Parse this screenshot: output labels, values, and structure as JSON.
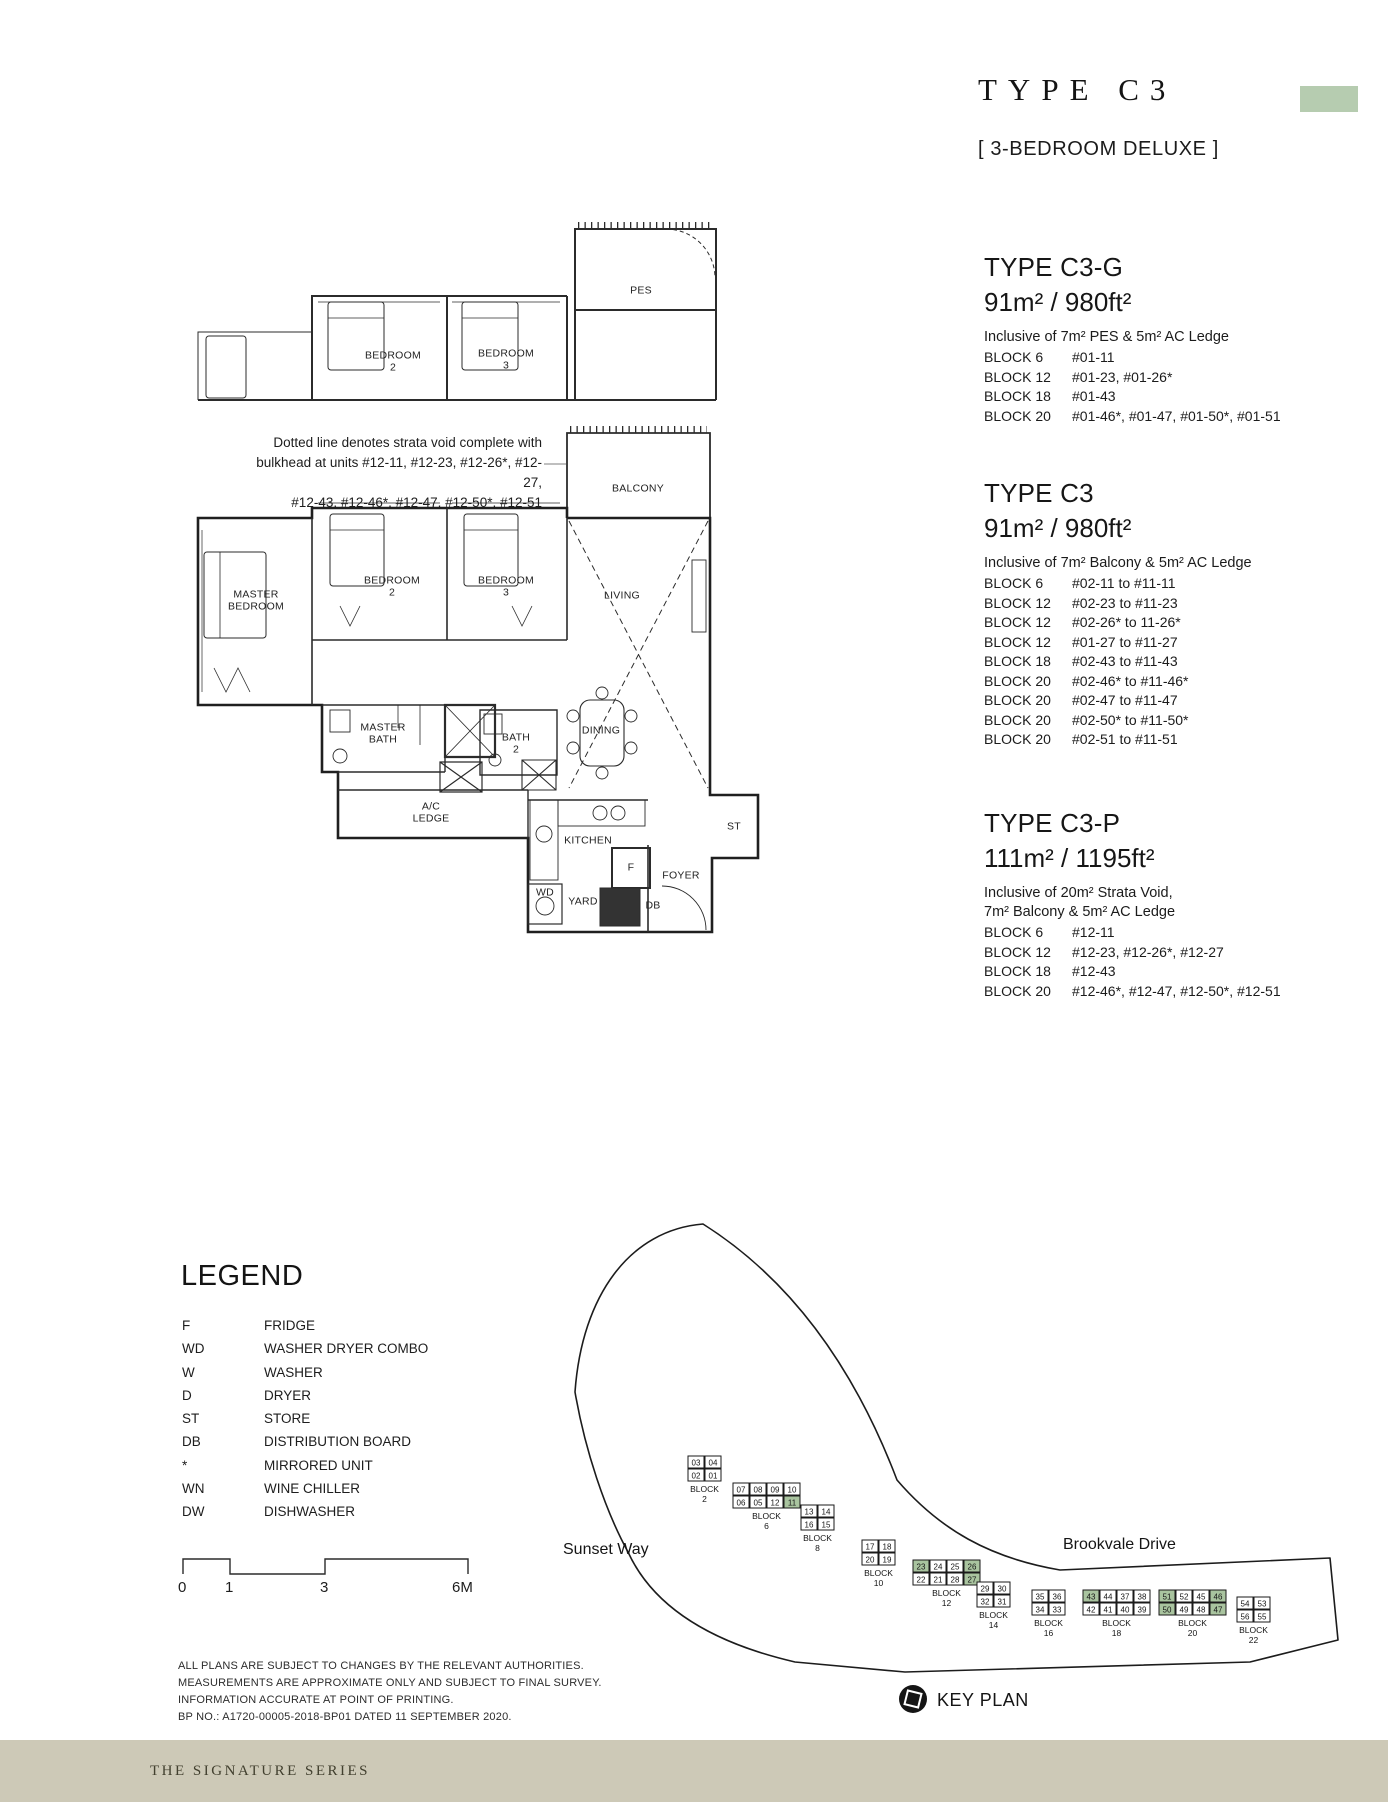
{
  "header": {
    "title": "TYPE C3",
    "subtitle": "[ 3-BEDROOM DELUXE ]"
  },
  "unit_types": [
    {
      "name": "TYPE C3-G",
      "area": "91m² / 980ft²",
      "inclusive": [
        "Inclusive of 7m² PES & 5m² AC Ledge"
      ],
      "blocks": [
        {
          "block": "BLOCK 6",
          "units": "#01-11"
        },
        {
          "block": "BLOCK 12",
          "units": "#01-23, #01-26*"
        },
        {
          "block": "BLOCK 18",
          "units": "#01-43"
        },
        {
          "block": "BLOCK 20",
          "units": "#01-46*, #01-47, #01-50*, #01-51"
        }
      ]
    },
    {
      "name": "TYPE C3",
      "area": "91m² / 980ft²",
      "inclusive": [
        "Inclusive of 7m² Balcony & 5m² AC Ledge"
      ],
      "blocks": [
        {
          "block": "BLOCK 6",
          "units": "#02-11 to #11-11"
        },
        {
          "block": "BLOCK 12",
          "units": "#02-23 to #11-23"
        },
        {
          "block": "BLOCK 12",
          "units": "#02-26* to 11-26*"
        },
        {
          "block": "BLOCK 12",
          "units": "#01-27 to #11-27"
        },
        {
          "block": "BLOCK 18",
          "units": "#02-43 to #11-43"
        },
        {
          "block": "BLOCK 20",
          "units": "#02-46* to #11-46*"
        },
        {
          "block": "BLOCK 20",
          "units": "#02-47 to #11-47"
        },
        {
          "block": "BLOCK 20",
          "units": "#02-50* to #11-50*"
        },
        {
          "block": "BLOCK 20",
          "units": "#02-51 to #11-51"
        }
      ]
    },
    {
      "name": "TYPE C3-P",
      "area": "111m² / 1195ft²",
      "inclusive": [
        "Inclusive of 20m² Strata Void,",
        "7m² Balcony & 5m² AC Ledge"
      ],
      "blocks": [
        {
          "block": "BLOCK 6",
          "units": "#12-11"
        },
        {
          "block": "BLOCK 12",
          "units": "#12-23, #12-26*, #12-27"
        },
        {
          "block": "BLOCK 18",
          "units": "#12-43"
        },
        {
          "block": "BLOCK 20",
          "units": "#12-46*, #12-47, #12-50*, #12-51"
        }
      ]
    }
  ],
  "strata_note": [
    "Dotted line denotes strata void complete with",
    "bulkhead at units #12-11, #12-23, #12-26*, #12-27,",
    "#12-43, #12-46*, #12-47, #12-50*, #12-51"
  ],
  "plan_labels": {
    "pes": "PES",
    "balcony": "BALCONY",
    "bedroom2": [
      "BEDROOM",
      "2"
    ],
    "bedroom3": [
      "BEDROOM",
      "3"
    ],
    "master_bedroom": [
      "MASTER",
      "BEDROOM"
    ],
    "living": "LIVING",
    "dining": "DINING",
    "master_bath": [
      "MASTER",
      "BATH"
    ],
    "bath2": [
      "BATH",
      "2"
    ],
    "ac_ledge": [
      "A/C",
      "LEDGE"
    ],
    "kitchen": "KITCHEN",
    "st": "ST",
    "foyer": "FOYER",
    "fridge": "F",
    "wd": "WD",
    "yard": "YARD",
    "db": "DB"
  },
  "legend": {
    "title": "LEGEND",
    "items": [
      {
        "key": "F",
        "value": "FRIDGE"
      },
      {
        "key": "WD",
        "value": "WASHER DRYER COMBO"
      },
      {
        "key": "W",
        "value": "WASHER"
      },
      {
        "key": "D",
        "value": "DRYER"
      },
      {
        "key": "ST",
        "value": "STORE"
      },
      {
        "key": "DB",
        "value": "DISTRIBUTION BOARD"
      },
      {
        "key": "*",
        "value": "MIRRORED UNIT"
      },
      {
        "key": "WN",
        "value": "WINE CHILLER"
      },
      {
        "key": "DW",
        "value": "DISHWASHER"
      }
    ]
  },
  "scale_bar": {
    "labels": [
      "0",
      "1",
      "3",
      "6M"
    ]
  },
  "disclaimer": [
    "ALL PLANS ARE SUBJECT TO CHANGES BY THE RELEVANT AUTHORITIES.",
    "MEASUREMENTS ARE APPROXIMATE ONLY AND SUBJECT TO FINAL SURVEY.",
    "INFORMATION ACCURATE AT POINT OF PRINTING.",
    "BP NO.: A1720-00005-2018-BP01 DATED 11 SEPTEMBER 2020."
  ],
  "key_plan": {
    "label": "KEY PLAN",
    "roads": {
      "left": "Sunset Way",
      "right": "Brookvale Drive"
    },
    "highlight_color": "#a9c49f",
    "blocks": [
      {
        "name": "BLOCK 2",
        "rows": [
          [
            "03",
            "04"
          ],
          [
            "02",
            "01"
          ]
        ]
      },
      {
        "name": "BLOCK 6",
        "rows": [
          [
            "07",
            "08",
            "09",
            "10"
          ],
          [
            "06",
            "05",
            "12",
            "11"
          ]
        ],
        "highlight": [
          "11"
        ]
      },
      {
        "name": "BLOCK 8",
        "rows": [
          [
            "13",
            "14"
          ],
          [
            "16",
            "15"
          ]
        ]
      },
      {
        "name": "BLOCK 10",
        "rows": [
          [
            "17",
            "18"
          ],
          [
            "20",
            "19"
          ]
        ]
      },
      {
        "name": "BLOCK 12",
        "rows": [
          [
            "23",
            "24",
            "25",
            "26"
          ],
          [
            "22",
            "21",
            "28",
            "27"
          ]
        ],
        "highlight": [
          "23",
          "26",
          "27"
        ]
      },
      {
        "name": "BLOCK 14",
        "rows": [
          [
            "29",
            "30"
          ],
          [
            "32",
            "31"
          ]
        ]
      },
      {
        "name": "BLOCK 16",
        "rows": [
          [
            "35",
            "36"
          ],
          [
            "34",
            "33"
          ]
        ]
      },
      {
        "name": "BLOCK 18",
        "rows": [
          [
            "43",
            "44",
            "37",
            "38"
          ],
          [
            "42",
            "41",
            "40",
            "39"
          ]
        ],
        "highlight": [
          "43"
        ]
      },
      {
        "name": "BLOCK 20",
        "rows": [
          [
            "51",
            "52",
            "45",
            "46"
          ],
          [
            "50",
            "49",
            "48",
            "47"
          ]
        ],
        "highlight": [
          "51",
          "46",
          "50",
          "47"
        ]
      },
      {
        "name": "BLOCK 22",
        "rows": [
          [
            "54",
            "53"
          ],
          [
            "56",
            "55"
          ]
        ]
      }
    ]
  },
  "footer": {
    "text": "THE SIGNATURE SERIES"
  },
  "colors": {
    "accent": "#b6ccb0",
    "footer_bg": "#cdc9b7",
    "highlight": "#a9c49f"
  }
}
